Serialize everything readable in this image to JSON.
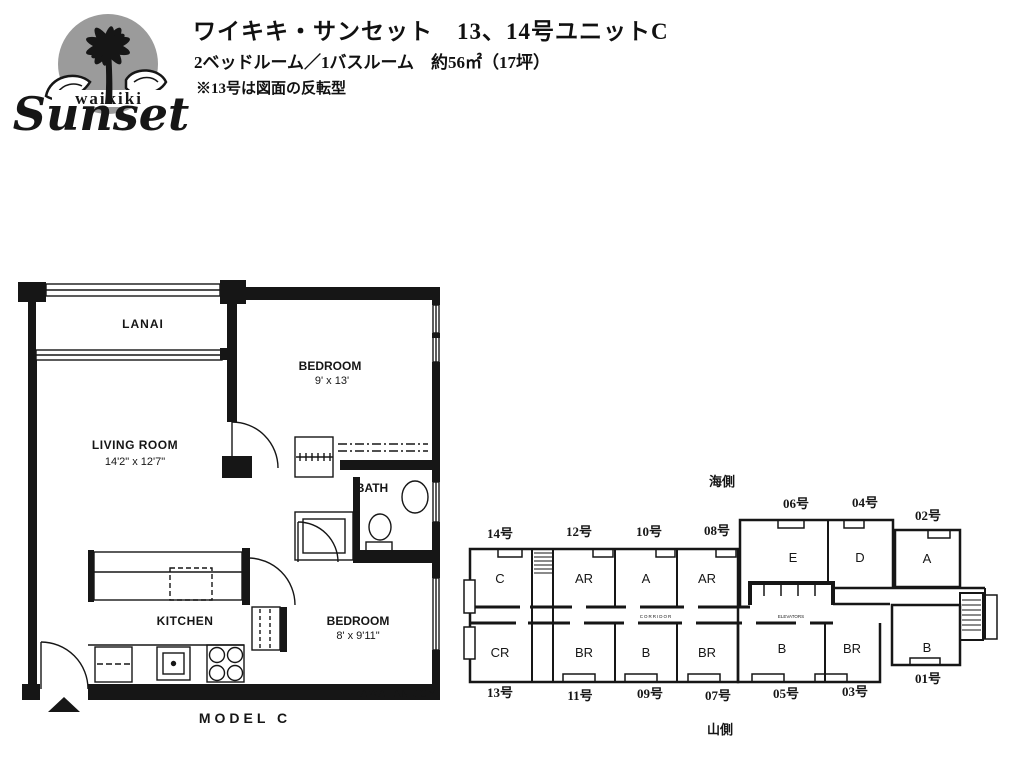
{
  "header": {
    "logo": {
      "top_text": "waikiki",
      "main_text": "Sunset"
    },
    "title": "ワイキキ・サンセット　13、14号ユニットC",
    "subtitle": "2ベッドルーム／1バスルーム　約56㎡（17坪）",
    "note": "※13号は図面の反転型"
  },
  "unit_plan": {
    "caption": "MODEL C",
    "watermark": "HAWAIIAN JOY",
    "rooms": {
      "lanai": {
        "label": "LANAI"
      },
      "bedroom1": {
        "label": "BEDROOM",
        "dims": "9' x 13'"
      },
      "living": {
        "label": "LIVING ROOM",
        "dims": "14'2\" x 12'7\""
      },
      "bath": {
        "label": "BATH"
      },
      "kitchen": {
        "label": "KITCHEN"
      },
      "bedroom2": {
        "label": "BEDROOM",
        "dims": "8' x 9'11\""
      }
    }
  },
  "building_plate": {
    "sea_side_label": "海側",
    "mountain_side_label": "山側",
    "corridor_label": "CORRIDOR",
    "elevators_label": "ELEVATORS",
    "top_units": [
      {
        "no": "14号",
        "type": "C"
      },
      {
        "no": "12号",
        "type": "AR"
      },
      {
        "no": "10号",
        "type": "A"
      },
      {
        "no": "08号",
        "type": "AR"
      },
      {
        "no": "06号",
        "type": "E"
      },
      {
        "no": "04号",
        "type": "D"
      },
      {
        "no": "02号",
        "type": "A"
      }
    ],
    "bottom_units": [
      {
        "no": "13号",
        "type": "CR"
      },
      {
        "no": "11号",
        "type": "BR"
      },
      {
        "no": "09号",
        "type": "B"
      },
      {
        "no": "07号",
        "type": "BR"
      },
      {
        "no": "05号",
        "type": "B"
      },
      {
        "no": "03号",
        "type": "BR"
      },
      {
        "no": "01号",
        "type": "B"
      }
    ]
  },
  "colors": {
    "ink": "#161616",
    "logo_gray": "#9b9b9b"
  }
}
